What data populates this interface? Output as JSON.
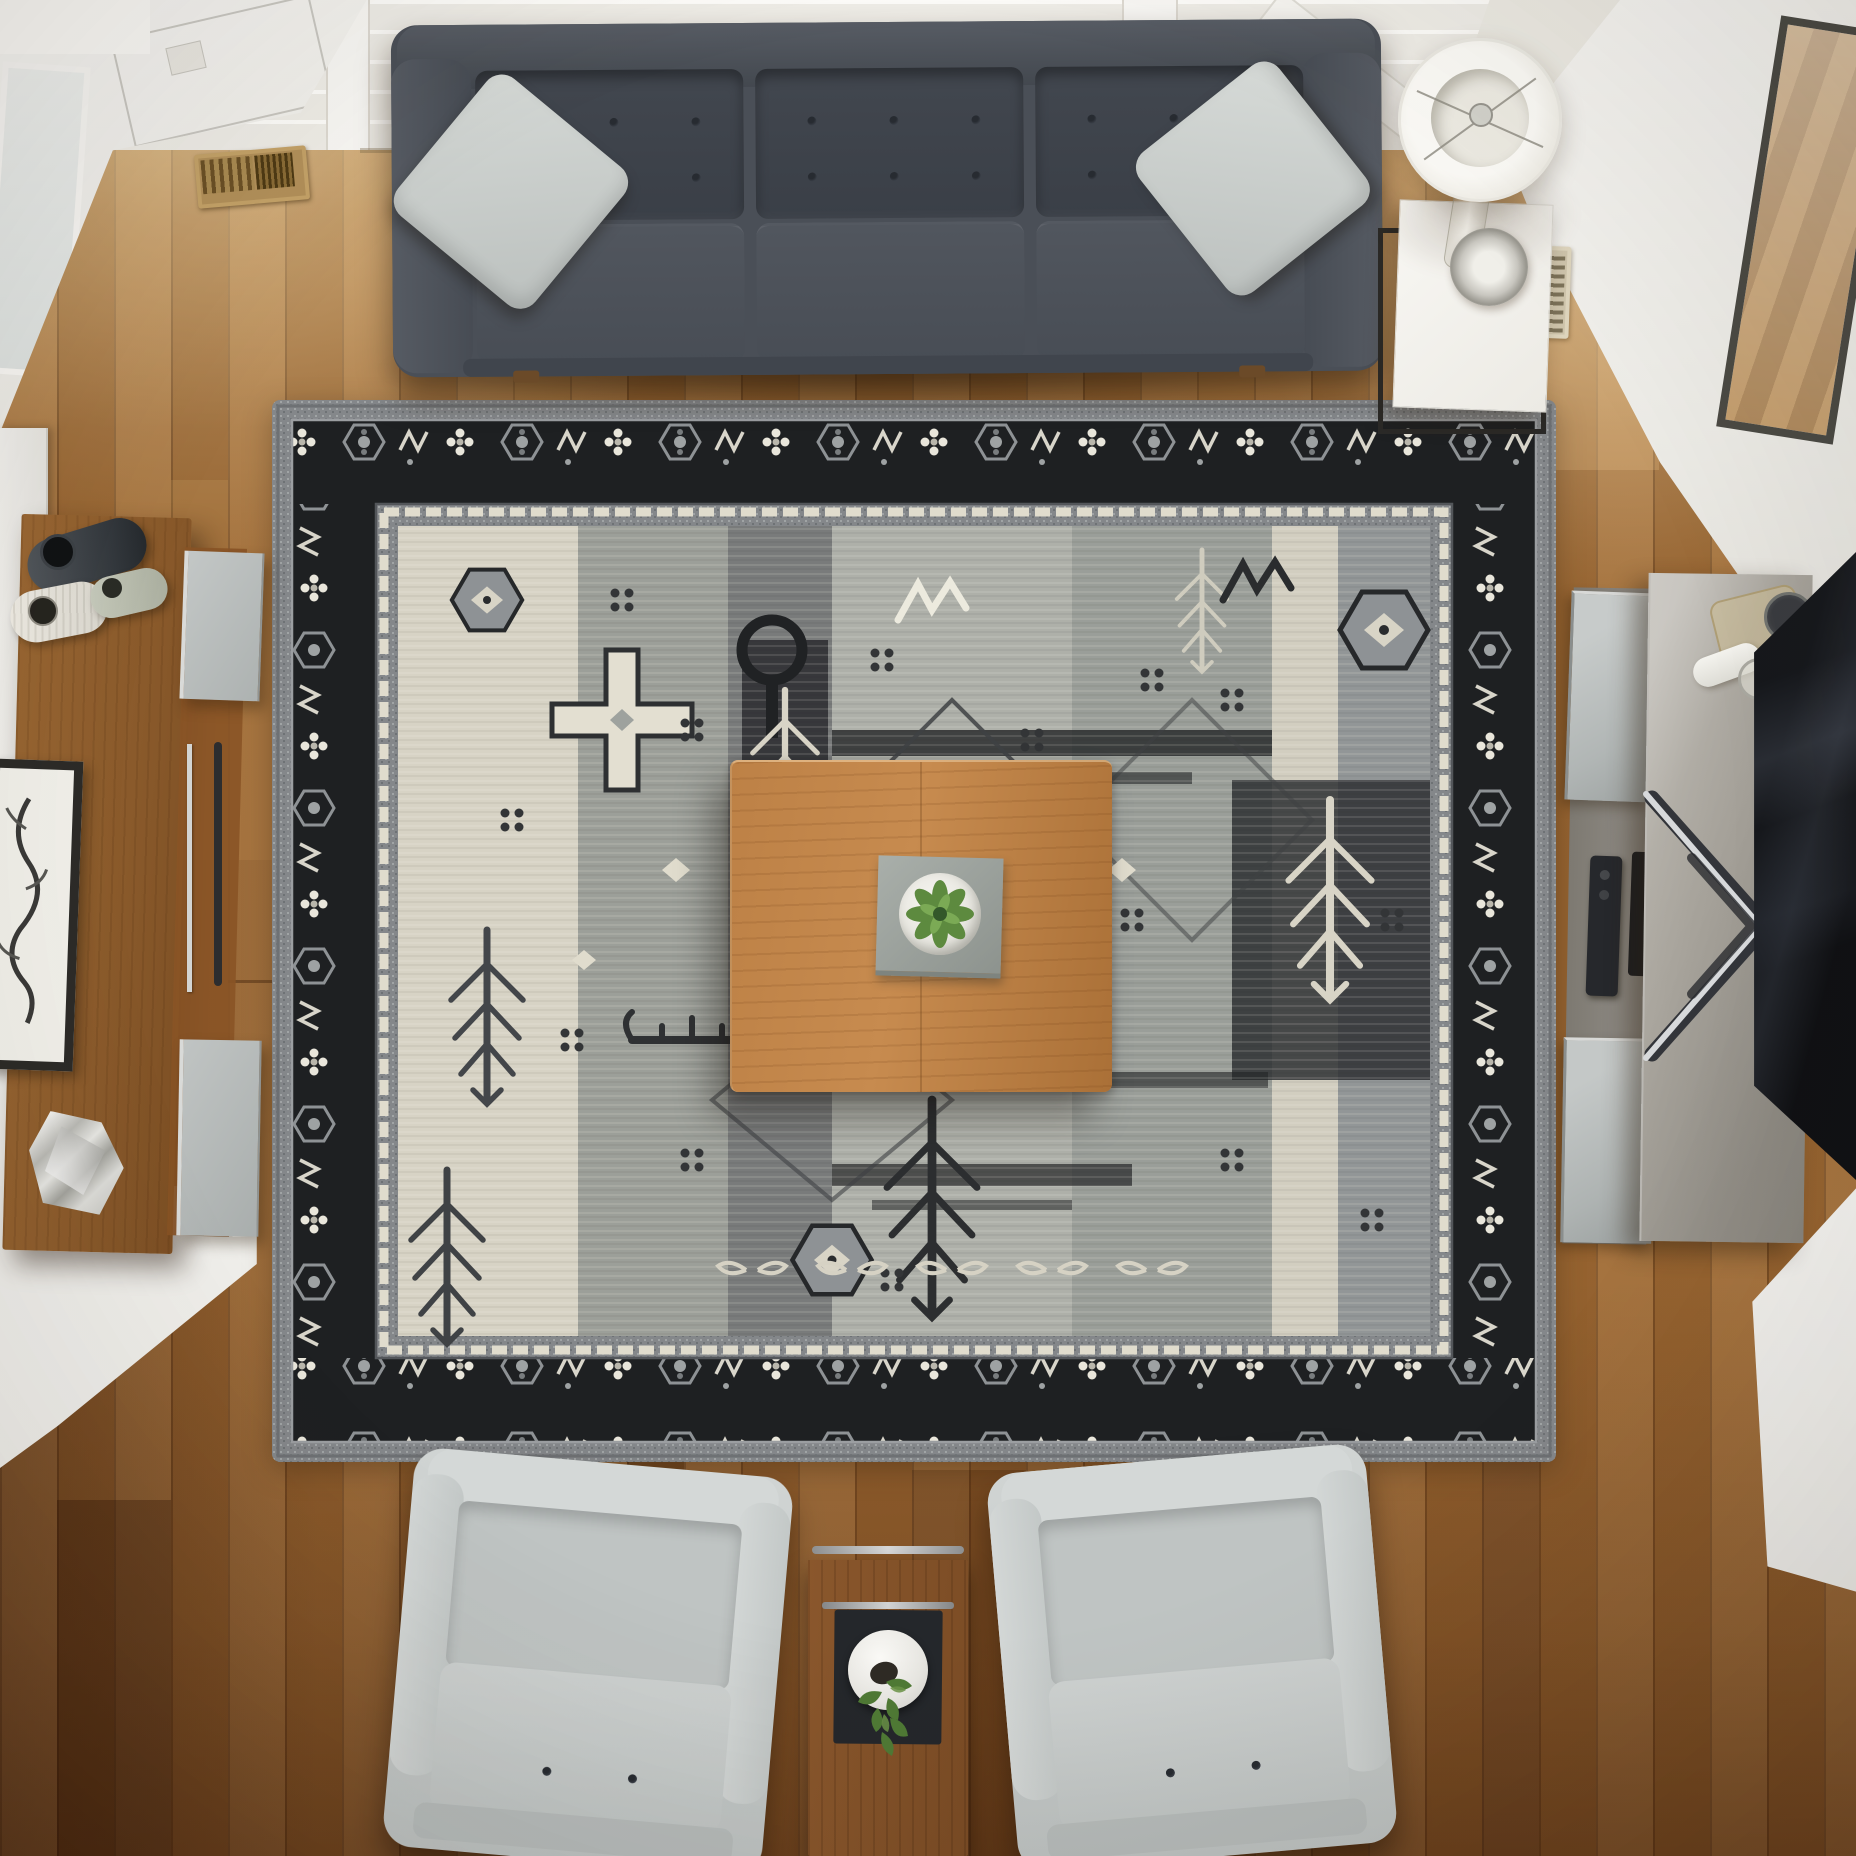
{
  "scene": {
    "type": "photograph",
    "view": "top-down overhead view of a modern living room",
    "description": "Overhead view of a living room: charcoal tufted sofa with two light gray pillows at top, large gray-black tribal area rug, square walnut coffee table with succulent, two light gray armchairs with walnut end table at bottom, walnut sideboard with vases at left, greige media console with TV at right, hardwood floors and white walls with windows."
  },
  "palette": {
    "floor_wood": "#a06c36",
    "floor_dark": "#5f3319",
    "sofa_charcoal": "#4a4f57",
    "pillow_gray": "#cbd0cd",
    "armchair_gray": "#c6cbca",
    "rug_field": "#a9aba6",
    "rug_ivory": "#d9d5c6",
    "rug_black": "#1e2022",
    "walnut": "#92602f",
    "coffee_table": "#bc8045",
    "console_greige": "#a7a39b",
    "tv_black": "#14161a",
    "wall_white": "#f3f2ef",
    "plant_green": "#55823a",
    "lamp_white": "#f7f5f0",
    "vent_brass": "#a8874f"
  },
  "objects": {
    "hardwood_floor": {
      "label": "hardwood plank floor"
    },
    "skylight": {
      "label": "bright windows along top wall"
    },
    "wall_top_left": {
      "label": "white wall corner with windows"
    },
    "wall_top_right": {
      "label": "white wall corner with deck window"
    },
    "sofa": {
      "label": "charcoal three-seat tufted sofa",
      "pillows": 2
    },
    "throw_pillow_left": {
      "label": "light gray throw pillow"
    },
    "throw_pillow_right": {
      "label": "light gray throw pillow"
    },
    "area_rug": {
      "label": "gray and black tribal-pattern area rug"
    },
    "coffee_table": {
      "label": "square walnut coffee table"
    },
    "succulent": {
      "label": "potted succulent on gray tray"
    },
    "side_table": {
      "label": "white-top side table with black metal frame"
    },
    "table_lamp": {
      "label": "table lamp with white drum shade and glass base"
    },
    "sideboard": {
      "label": "walnut sideboard with gray glass doors"
    },
    "vase_dark": {
      "label": "dark ceramic vase"
    },
    "vase_white": {
      "label": "white ribbed ceramic vase"
    },
    "vase_sage": {
      "label": "sage ceramic vase"
    },
    "framed_art": {
      "label": "framed botanical print leaning at left"
    },
    "glass_sculpture": {
      "label": "faceted glass sculpture"
    },
    "media_console": {
      "label": "greige media console"
    },
    "tv": {
      "label": "flat-screen television on x-stand"
    },
    "remotes": {
      "label": "two remote controls in open shelf"
    },
    "armchair_left": {
      "label": "light gray armchair"
    },
    "armchair_right": {
      "label": "light gray armchair"
    },
    "end_table": {
      "label": "walnut end table with white vase and greenery"
    },
    "floor_vent_left": {
      "label": "brass floor vent"
    },
    "floor_vent_right": {
      "label": "beige floor vent"
    }
  }
}
